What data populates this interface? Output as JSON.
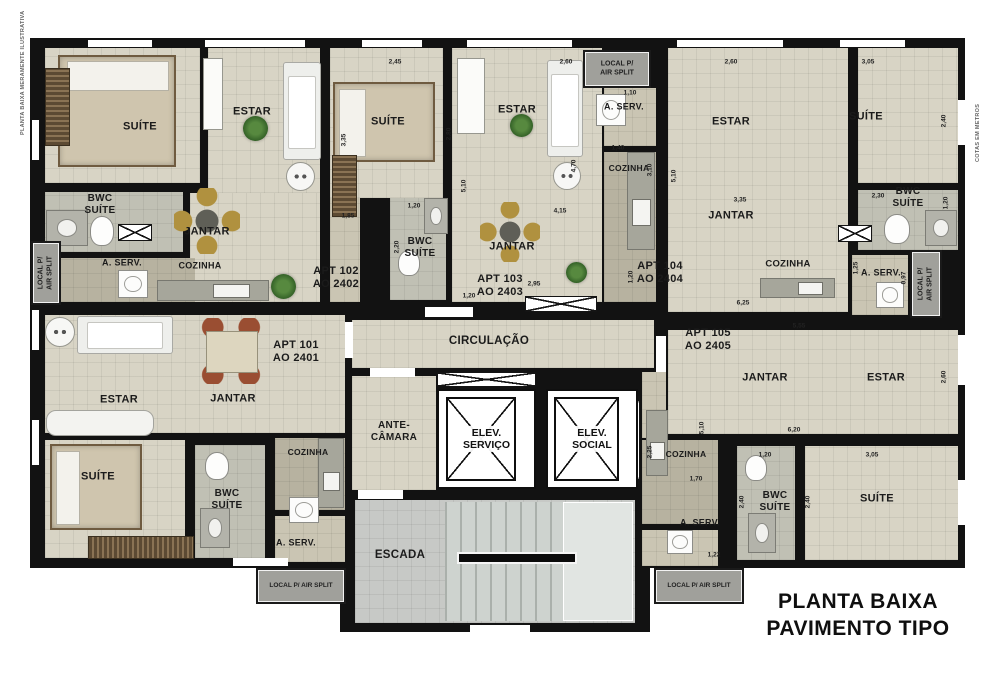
{
  "title": {
    "line1": "PLANTA BAIXA",
    "line2": "PAVIMENTO TIPO"
  },
  "edge_notes": {
    "left": "PLANTA BAIXA MERAMENTE ILUSTRATIVA",
    "right": "COTAS EM METROS"
  },
  "apartments": [
    {
      "id": "APT 101",
      "unit": "AO 2401"
    },
    {
      "id": "APT 102",
      "unit": "AO 2402"
    },
    {
      "id": "APT 103",
      "unit": "AO 2403"
    },
    {
      "id": "APT 104",
      "unit": "AO 2404"
    },
    {
      "id": "APT 105",
      "unit": "AO 2405"
    }
  ],
  "colors": {
    "wall": "#121212",
    "floor_light": "#d8d4c5",
    "floor_mid": "#cac5b3",
    "floor_dark": "#b7b2a0",
    "floor_bwc": "#c0c0b4",
    "stair": "#c7c9c6",
    "airsplit": "#a0a09b"
  },
  "plan": {
    "slabs": [
      [
        30,
        38,
        935,
        530
      ],
      [
        340,
        485,
        310,
        147
      ]
    ],
    "floors": [
      [
        45,
        48,
        155,
        135,
        "l"
      ],
      [
        208,
        48,
        112,
        145,
        "l"
      ],
      [
        190,
        193,
        130,
        109,
        "l"
      ],
      [
        45,
        192,
        138,
        60,
        "b"
      ],
      [
        45,
        258,
        150,
        44,
        "d"
      ],
      [
        330,
        48,
        113,
        150,
        "l"
      ],
      [
        330,
        198,
        30,
        104,
        "m"
      ],
      [
        452,
        48,
        150,
        254,
        "l"
      ],
      [
        390,
        198,
        56,
        102,
        "b"
      ],
      [
        604,
        88,
        52,
        58,
        "m"
      ],
      [
        604,
        152,
        52,
        150,
        "d"
      ],
      [
        668,
        48,
        180,
        264,
        "l"
      ],
      [
        858,
        48,
        100,
        135,
        "l"
      ],
      [
        858,
        190,
        100,
        60,
        "b"
      ],
      [
        852,
        255,
        56,
        60,
        "m"
      ],
      [
        45,
        315,
        300,
        118,
        "l"
      ],
      [
        45,
        440,
        140,
        118,
        "l"
      ],
      [
        195,
        445,
        70,
        113,
        "b"
      ],
      [
        275,
        438,
        70,
        72,
        "d"
      ],
      [
        275,
        516,
        70,
        46,
        "m"
      ],
      [
        352,
        320,
        302,
        48,
        "l"
      ],
      [
        352,
        376,
        84,
        114,
        "l"
      ],
      [
        355,
        500,
        280,
        123,
        "s"
      ],
      [
        668,
        330,
        290,
        104,
        "l"
      ],
      [
        642,
        372,
        24,
        66,
        "m"
      ],
      [
        642,
        440,
        76,
        84,
        "d"
      ],
      [
        642,
        530,
        76,
        36,
        "m"
      ],
      [
        737,
        446,
        58,
        114,
        "b"
      ],
      [
        805,
        446,
        153,
        114,
        "l"
      ]
    ],
    "openings": [
      [
        88,
        40,
        64,
        7
      ],
      [
        205,
        40,
        100,
        7
      ],
      [
        362,
        40,
        60,
        7
      ],
      [
        467,
        40,
        105,
        7
      ],
      [
        677,
        40,
        106,
        7
      ],
      [
        840,
        40,
        65,
        7
      ],
      [
        32,
        120,
        7,
        40
      ],
      [
        32,
        310,
        7,
        40
      ],
      [
        32,
        420,
        7,
        45
      ],
      [
        958,
        100,
        7,
        45
      ],
      [
        958,
        335,
        7,
        50
      ],
      [
        958,
        480,
        7,
        45
      ],
      [
        233,
        558,
        55,
        8
      ],
      [
        470,
        625,
        60,
        7
      ],
      [
        425,
        307,
        48,
        10
      ],
      [
        345,
        322,
        8,
        36
      ],
      [
        656,
        336,
        10,
        36
      ],
      [
        370,
        368,
        45,
        9
      ],
      [
        358,
        490,
        45,
        9
      ]
    ],
    "xboxes": [
      [
        525,
        296,
        72,
        16
      ],
      [
        437,
        372,
        99,
        15
      ],
      [
        614,
        396,
        26,
        88
      ],
      [
        838,
        225,
        34,
        17
      ],
      [
        118,
        224,
        34,
        17
      ]
    ],
    "furniture": [
      {
        "t": "bed",
        "x": 58,
        "y": 55,
        "w": 118,
        "h": 112
      },
      {
        "t": "bed h",
        "x": 333,
        "y": 82,
        "w": 102,
        "h": 80
      },
      {
        "t": "bed h",
        "x": 50,
        "y": 444,
        "w": 92,
        "h": 86
      },
      {
        "t": "ward v",
        "x": 45,
        "y": 68,
        "w": 25,
        "h": 78
      },
      {
        "t": "ward v",
        "x": 332,
        "y": 155,
        "w": 25,
        "h": 62
      },
      {
        "t": "ward h",
        "x": 88,
        "y": 536,
        "w": 106,
        "h": 23
      },
      {
        "t": "console",
        "x": 203,
        "y": 58,
        "w": 20,
        "h": 72
      },
      {
        "t": "console",
        "x": 457,
        "y": 58,
        "w": 28,
        "h": 76
      },
      {
        "t": "tub",
        "x": 46,
        "y": 410,
        "w": 108,
        "h": 26
      },
      {
        "t": "sofa v",
        "x": 283,
        "y": 62,
        "w": 38,
        "h": 98
      },
      {
        "t": "sofa v",
        "x": 547,
        "y": 60,
        "w": 36,
        "h": 97
      },
      {
        "t": "sofa h",
        "x": 77,
        "y": 316,
        "w": 96,
        "h": 38
      },
      {
        "t": "dine",
        "x": 174,
        "y": 188,
        "w": 66,
        "h": 66
      },
      {
        "t": "dine",
        "x": 480,
        "y": 202,
        "w": 60,
        "h": 60
      },
      {
        "t": "dine rect",
        "x": 193,
        "y": 318,
        "w": 76,
        "h": 66
      },
      {
        "t": "round",
        "x": 286,
        "y": 162,
        "w": 29,
        "h": 29
      },
      {
        "t": "round",
        "x": 553,
        "y": 162,
        "w": 28,
        "h": 28
      },
      {
        "t": "round",
        "x": 45,
        "y": 317,
        "w": 30,
        "h": 30
      },
      {
        "t": "plant",
        "x": 243,
        "y": 116,
        "w": 25,
        "h": 25
      },
      {
        "t": "plant",
        "x": 510,
        "y": 114,
        "w": 23,
        "h": 23
      },
      {
        "t": "plant",
        "x": 566,
        "y": 262,
        "w": 21,
        "h": 21
      },
      {
        "t": "plant",
        "x": 271,
        "y": 274,
        "w": 25,
        "h": 25
      },
      {
        "t": "counter h",
        "x": 157,
        "y": 280,
        "w": 112,
        "h": 21
      },
      {
        "t": "counter v",
        "x": 627,
        "y": 152,
        "w": 28,
        "h": 98
      },
      {
        "t": "counter h",
        "x": 760,
        "y": 278,
        "w": 75,
        "h": 20
      },
      {
        "t": "counter v",
        "x": 318,
        "y": 438,
        "w": 26,
        "h": 70
      },
      {
        "t": "counter v",
        "x": 646,
        "y": 410,
        "w": 22,
        "h": 66
      },
      {
        "t": "washer",
        "x": 118,
        "y": 270,
        "w": 30,
        "h": 28
      },
      {
        "t": "washer",
        "x": 596,
        "y": 94,
        "w": 30,
        "h": 32
      },
      {
        "t": "washer",
        "x": 876,
        "y": 282,
        "w": 28,
        "h": 26
      },
      {
        "t": "washer",
        "x": 289,
        "y": 497,
        "w": 30,
        "h": 26
      },
      {
        "t": "washer",
        "x": 667,
        "y": 530,
        "w": 26,
        "h": 24
      },
      {
        "t": "sinkbox",
        "x": 46,
        "y": 210,
        "w": 42,
        "h": 36
      },
      {
        "t": "wc",
        "x": 90,
        "y": 216,
        "w": 24,
        "h": 30
      },
      {
        "t": "sinkbox",
        "x": 424,
        "y": 198,
        "w": 24,
        "h": 36
      },
      {
        "t": "wc",
        "x": 398,
        "y": 250,
        "w": 22,
        "h": 26
      },
      {
        "t": "wc",
        "x": 884,
        "y": 214,
        "w": 26,
        "h": 30
      },
      {
        "t": "sinkbox",
        "x": 925,
        "y": 210,
        "w": 32,
        "h": 36
      },
      {
        "t": "wc",
        "x": 205,
        "y": 452,
        "w": 24,
        "h": 28
      },
      {
        "t": "sinkbox",
        "x": 200,
        "y": 508,
        "w": 30,
        "h": 40
      },
      {
        "t": "wc",
        "x": 745,
        "y": 455,
        "w": 22,
        "h": 26
      },
      {
        "t": "sinkbox",
        "x": 748,
        "y": 513,
        "w": 28,
        "h": 40
      },
      {
        "t": "stairs",
        "x": 445,
        "y": 502,
        "w": 118,
        "h": 119
      },
      {
        "t": "landing",
        "x": 563,
        "y": 502,
        "w": 70,
        "h": 119
      },
      {
        "t": "rail",
        "x": 457,
        "y": 552,
        "w": 120,
        "h": 12
      }
    ],
    "elevators": [
      {
        "label": "ELEV.\nSERVIÇO",
        "x": 437,
        "y": 389,
        "w": 99,
        "h": 100
      },
      {
        "label": "ELEV.\nSOCIAL",
        "x": 546,
        "y": 389,
        "w": 92,
        "h": 100
      }
    ],
    "airsplits": [
      {
        "text": "LOCAL P/\nAIR SPLIT",
        "x": 585,
        "y": 52,
        "w": 64,
        "h": 34
      },
      {
        "text": "LOCAL P/\nAIR SPLIT",
        "x": 33,
        "y": 243,
        "w": 26,
        "h": 60,
        "v": 1
      },
      {
        "text": "LOCAL P/\nAIR SPLIT",
        "x": 912,
        "y": 252,
        "w": 28,
        "h": 64,
        "v": 1
      },
      {
        "text": "LOCAL P/ AIR SPLIT",
        "x": 258,
        "y": 570,
        "w": 86,
        "h": 32,
        "s": 1
      },
      {
        "text": "LOCAL P/ AIR SPLIT",
        "x": 656,
        "y": 570,
        "w": 86,
        "h": 32,
        "s": 1
      }
    ],
    "labels": [
      {
        "t": "SUÍTE",
        "x": 140,
        "y": 127
      },
      {
        "t": "ESTAR",
        "x": 252,
        "y": 112
      },
      {
        "t": "BWC\nSUÍTE",
        "x": 100,
        "y": 205,
        "fs": 10
      },
      {
        "t": "A. SERV.",
        "x": 122,
        "y": 263,
        "fs": 9
      },
      {
        "t": "COZINHA",
        "x": 200,
        "y": 266,
        "fs": 9
      },
      {
        "t": "JANTAR",
        "x": 207,
        "y": 232
      },
      {
        "t": "APT 102\nAO 2402",
        "x": 336,
        "y": 278
      },
      {
        "t": "SUÍTE",
        "x": 388,
        "y": 122
      },
      {
        "t": "ESTAR",
        "x": 517,
        "y": 110
      },
      {
        "t": "JANTAR",
        "x": 512,
        "y": 247
      },
      {
        "t": "BWC\nSUÍTE",
        "x": 420,
        "y": 248,
        "fs": 10
      },
      {
        "t": "A. SERV.",
        "x": 624,
        "y": 107,
        "fs": 9
      },
      {
        "t": "COZINHA",
        "x": 629,
        "y": 168,
        "fs": 8.5
      },
      {
        "t": "APT 103\nAO 2403",
        "x": 500,
        "y": 286
      },
      {
        "t": "ESTAR",
        "x": 731,
        "y": 122
      },
      {
        "t": "SUÍTE",
        "x": 866,
        "y": 117
      },
      {
        "t": "JANTAR",
        "x": 731,
        "y": 216
      },
      {
        "t": "BWC\nSUÍTE",
        "x": 908,
        "y": 198,
        "fs": 10
      },
      {
        "t": "COZINHA",
        "x": 788,
        "y": 264,
        "fs": 9.5
      },
      {
        "t": "A. SERV.",
        "x": 881,
        "y": 273,
        "fs": 9
      },
      {
        "t": "APT 104\nAO 2404",
        "x": 660,
        "y": 273
      },
      {
        "t": "ESTAR",
        "x": 119,
        "y": 400
      },
      {
        "t": "JANTAR",
        "x": 233,
        "y": 399
      },
      {
        "t": "APT 101\nAO 2401",
        "x": 296,
        "y": 352
      },
      {
        "t": "SUÍTE",
        "x": 98,
        "y": 477
      },
      {
        "t": "BWC\nSUÍTE",
        "x": 227,
        "y": 500,
        "fs": 10
      },
      {
        "t": "COZINHA",
        "x": 308,
        "y": 452,
        "fs": 8.5
      },
      {
        "t": "A. SERV.",
        "x": 296,
        "y": 543,
        "fs": 9
      },
      {
        "t": "CIRCULAÇÃO",
        "x": 489,
        "y": 342,
        "fs": 11.5
      },
      {
        "t": "ANTE-\nCÂMARA",
        "x": 394,
        "y": 432,
        "fs": 10
      },
      {
        "t": "ESCADA",
        "x": 400,
        "y": 556,
        "fs": 11.5
      },
      {
        "t": "APT 105\nAO 2405",
        "x": 708,
        "y": 340
      },
      {
        "t": "JANTAR",
        "x": 765,
        "y": 378
      },
      {
        "t": "ESTAR",
        "x": 886,
        "y": 378
      },
      {
        "t": "COZINHA",
        "x": 686,
        "y": 454,
        "fs": 8.5
      },
      {
        "t": "A. SERV.",
        "x": 700,
        "y": 523,
        "fs": 9
      },
      {
        "t": "BWC\nSUÍTE",
        "x": 775,
        "y": 502,
        "fs": 10
      },
      {
        "t": "SUÍTE",
        "x": 877,
        "y": 499
      }
    ],
    "dims": [
      {
        "t": "2,45",
        "x": 395,
        "y": 62
      },
      {
        "t": "2,60",
        "x": 566,
        "y": 62
      },
      {
        "t": "2,60",
        "x": 731,
        "y": 62
      },
      {
        "t": "3,05",
        "x": 868,
        "y": 62
      },
      {
        "t": "2,40",
        "x": 944,
        "y": 121,
        "v": 1
      },
      {
        "t": "3,35",
        "x": 344,
        "y": 140,
        "v": 1
      },
      {
        "t": "2,80",
        "x": 449,
        "y": 134,
        "v": 1
      },
      {
        "t": "5,10",
        "x": 464,
        "y": 186,
        "v": 1
      },
      {
        "t": "4,70",
        "x": 574,
        "y": 166,
        "v": 1
      },
      {
        "t": "1,10",
        "x": 630,
        "y": 93
      },
      {
        "t": "1,40",
        "x": 618,
        "y": 148
      },
      {
        "t": "3,10",
        "x": 650,
        "y": 170,
        "v": 1
      },
      {
        "t": "5,10",
        "x": 674,
        "y": 176,
        "v": 1
      },
      {
        "t": "3,35",
        "x": 740,
        "y": 200
      },
      {
        "t": "2,30",
        "x": 878,
        "y": 196
      },
      {
        "t": "1,20",
        "x": 946,
        "y": 203,
        "v": 1
      },
      {
        "t": "1,85",
        "x": 348,
        "y": 216
      },
      {
        "t": "1,20",
        "x": 414,
        "y": 206
      },
      {
        "t": "2,20",
        "x": 397,
        "y": 247,
        "v": 1
      },
      {
        "t": "4,15",
        "x": 560,
        "y": 211
      },
      {
        "t": "2,95",
        "x": 534,
        "y": 284
      },
      {
        "t": "1,20",
        "x": 469,
        "y": 296
      },
      {
        "t": "1,20",
        "x": 631,
        "y": 277,
        "v": 1
      },
      {
        "t": "6,25",
        "x": 743,
        "y": 303
      },
      {
        "t": "1,25",
        "x": 856,
        "y": 268,
        "v": 1
      },
      {
        "t": "0,97",
        "x": 904,
        "y": 278,
        "v": 1
      },
      {
        "t": "5,55",
        "x": 799,
        "y": 326
      },
      {
        "t": "2,60",
        "x": 944,
        "y": 377,
        "v": 1
      },
      {
        "t": "5,10",
        "x": 702,
        "y": 428,
        "v": 1
      },
      {
        "t": "6,20",
        "x": 794,
        "y": 430
      },
      {
        "t": "1,20",
        "x": 765,
        "y": 455
      },
      {
        "t": "3,05",
        "x": 872,
        "y": 455
      },
      {
        "t": "2,40",
        "x": 742,
        "y": 502,
        "v": 1
      },
      {
        "t": "2,40",
        "x": 808,
        "y": 502,
        "v": 1
      },
      {
        "t": "2,25",
        "x": 650,
        "y": 452,
        "v": 1
      },
      {
        "t": "1,70",
        "x": 696,
        "y": 479
      },
      {
        "t": "1,22",
        "x": 714,
        "y": 555
      }
    ]
  }
}
